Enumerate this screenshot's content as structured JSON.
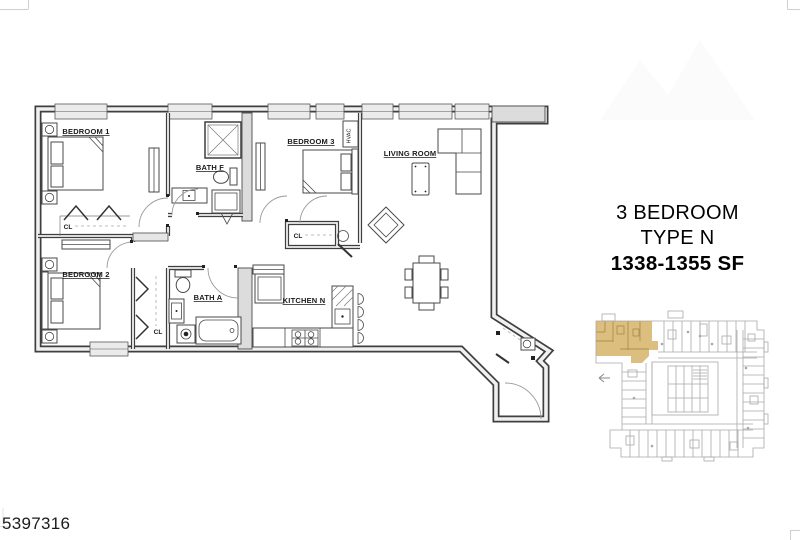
{
  "image": {
    "background": "#ffffff",
    "photo_id": "5397316"
  },
  "title_block": {
    "line1": "3 BEDROOM",
    "line2": "TYPE N",
    "line3": "1338-1355 SF"
  },
  "floor_plan": {
    "rooms": [
      {
        "label": "BEDROOM 1"
      },
      {
        "label": "BEDROOM 2"
      },
      {
        "label": "BEDROOM 3"
      },
      {
        "label": "BATH F"
      },
      {
        "label": "BATH A"
      },
      {
        "label": "KITCHEN N"
      },
      {
        "label": "LIVING ROOM"
      }
    ],
    "closet_label": "CL",
    "hvac_label": "HVAC"
  },
  "key_plan": {
    "highlight_color": "#dcbf7e",
    "line_color": "#a9a9a9"
  },
  "colors": {
    "plan_line": "#3f3f3f",
    "wall_core": "#f0f0f0",
    "window_fill": "#ebebeb",
    "chase_fill": "#dcdcdc"
  }
}
